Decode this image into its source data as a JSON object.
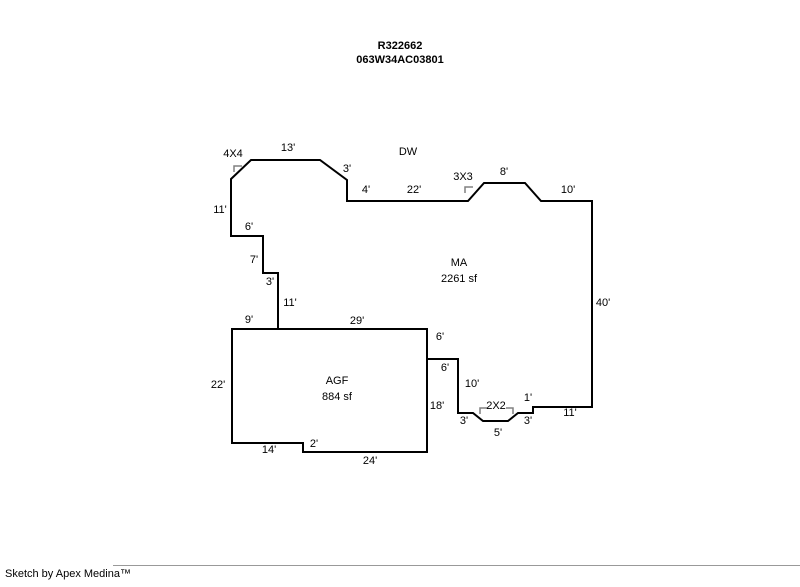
{
  "page": {
    "title_line1": "R322662",
    "title_line2": "063W34AC03801",
    "footer": "Sketch by Apex Medina™"
  },
  "colors": {
    "outline": "#000000",
    "corner_mark": "#808080",
    "text": "#000000",
    "footer_line": "#999999"
  },
  "sketch": {
    "areas": [
      {
        "id": "ma",
        "label": "MA",
        "area_label": "2261 sf",
        "label_x": 459,
        "label_y": 263,
        "points": "231,179 251,160 320,160 347,180 347,201 468,201 484,183 525,183 541,201 592,201 592,407 533,407 533,413 518,413 508,421 483,421 473,413 458,413 458,359 427,359 427,329 278,329 278,273 263,273 263,236 231,236"
      },
      {
        "id": "agf",
        "label": "AGF",
        "area_label": "884 sf",
        "label_x": 337,
        "label_y": 381,
        "points": "232,329 427,329 427,452 303,452 303,443 232,443"
      }
    ],
    "dimension_labels": [
      {
        "text": "4X4",
        "x": 233,
        "y": 154
      },
      {
        "text": "13'",
        "x": 288,
        "y": 148
      },
      {
        "text": "3'",
        "x": 347,
        "y": 169
      },
      {
        "text": "DW",
        "x": 408,
        "y": 152
      },
      {
        "text": "4'",
        "x": 366,
        "y": 190
      },
      {
        "text": "22'",
        "x": 414,
        "y": 190
      },
      {
        "text": "3X3",
        "x": 463,
        "y": 177
      },
      {
        "text": "8'",
        "x": 504,
        "y": 172
      },
      {
        "text": "10'",
        "x": 568,
        "y": 190
      },
      {
        "text": "11'",
        "x": 220,
        "y": 210
      },
      {
        "text": "6'",
        "x": 249,
        "y": 227
      },
      {
        "text": "7'",
        "x": 254,
        "y": 260
      },
      {
        "text": "3'",
        "x": 270,
        "y": 282
      },
      {
        "text": "11'",
        "x": 290,
        "y": 303
      },
      {
        "text": "9'",
        "x": 249,
        "y": 320
      },
      {
        "text": "29'",
        "x": 357,
        "y": 321
      },
      {
        "text": "40'",
        "x": 603,
        "y": 303
      },
      {
        "text": "6'",
        "x": 440,
        "y": 337
      },
      {
        "text": "6'",
        "x": 445,
        "y": 368
      },
      {
        "text": "10'",
        "x": 472,
        "y": 384
      },
      {
        "text": "22'",
        "x": 218,
        "y": 385
      },
      {
        "text": "18'",
        "x": 437,
        "y": 406
      },
      {
        "text": "3'",
        "x": 464,
        "y": 421
      },
      {
        "text": "2X2",
        "x": 496,
        "y": 406
      },
      {
        "text": "5'",
        "x": 498,
        "y": 433
      },
      {
        "text": "3'",
        "x": 528,
        "y": 421
      },
      {
        "text": "1'",
        "x": 528,
        "y": 398
      },
      {
        "text": "11'",
        "x": 570,
        "y": 413
      },
      {
        "text": "14'",
        "x": 269,
        "y": 450
      },
      {
        "text": "2'",
        "x": 314,
        "y": 444
      },
      {
        "text": "24'",
        "x": 370,
        "y": 461
      }
    ],
    "corner_marks": [
      {
        "id": "mark-4x4",
        "points": "234,172 234,166 242,166"
      },
      {
        "id": "mark-3x3",
        "points": "465,193 465,187 473,187"
      },
      {
        "id": "mark-2x2-left",
        "points": "480,414 480,408 487,408"
      },
      {
        "id": "mark-2x2-right",
        "points": "506,408 513,408 513,414"
      }
    ]
  }
}
